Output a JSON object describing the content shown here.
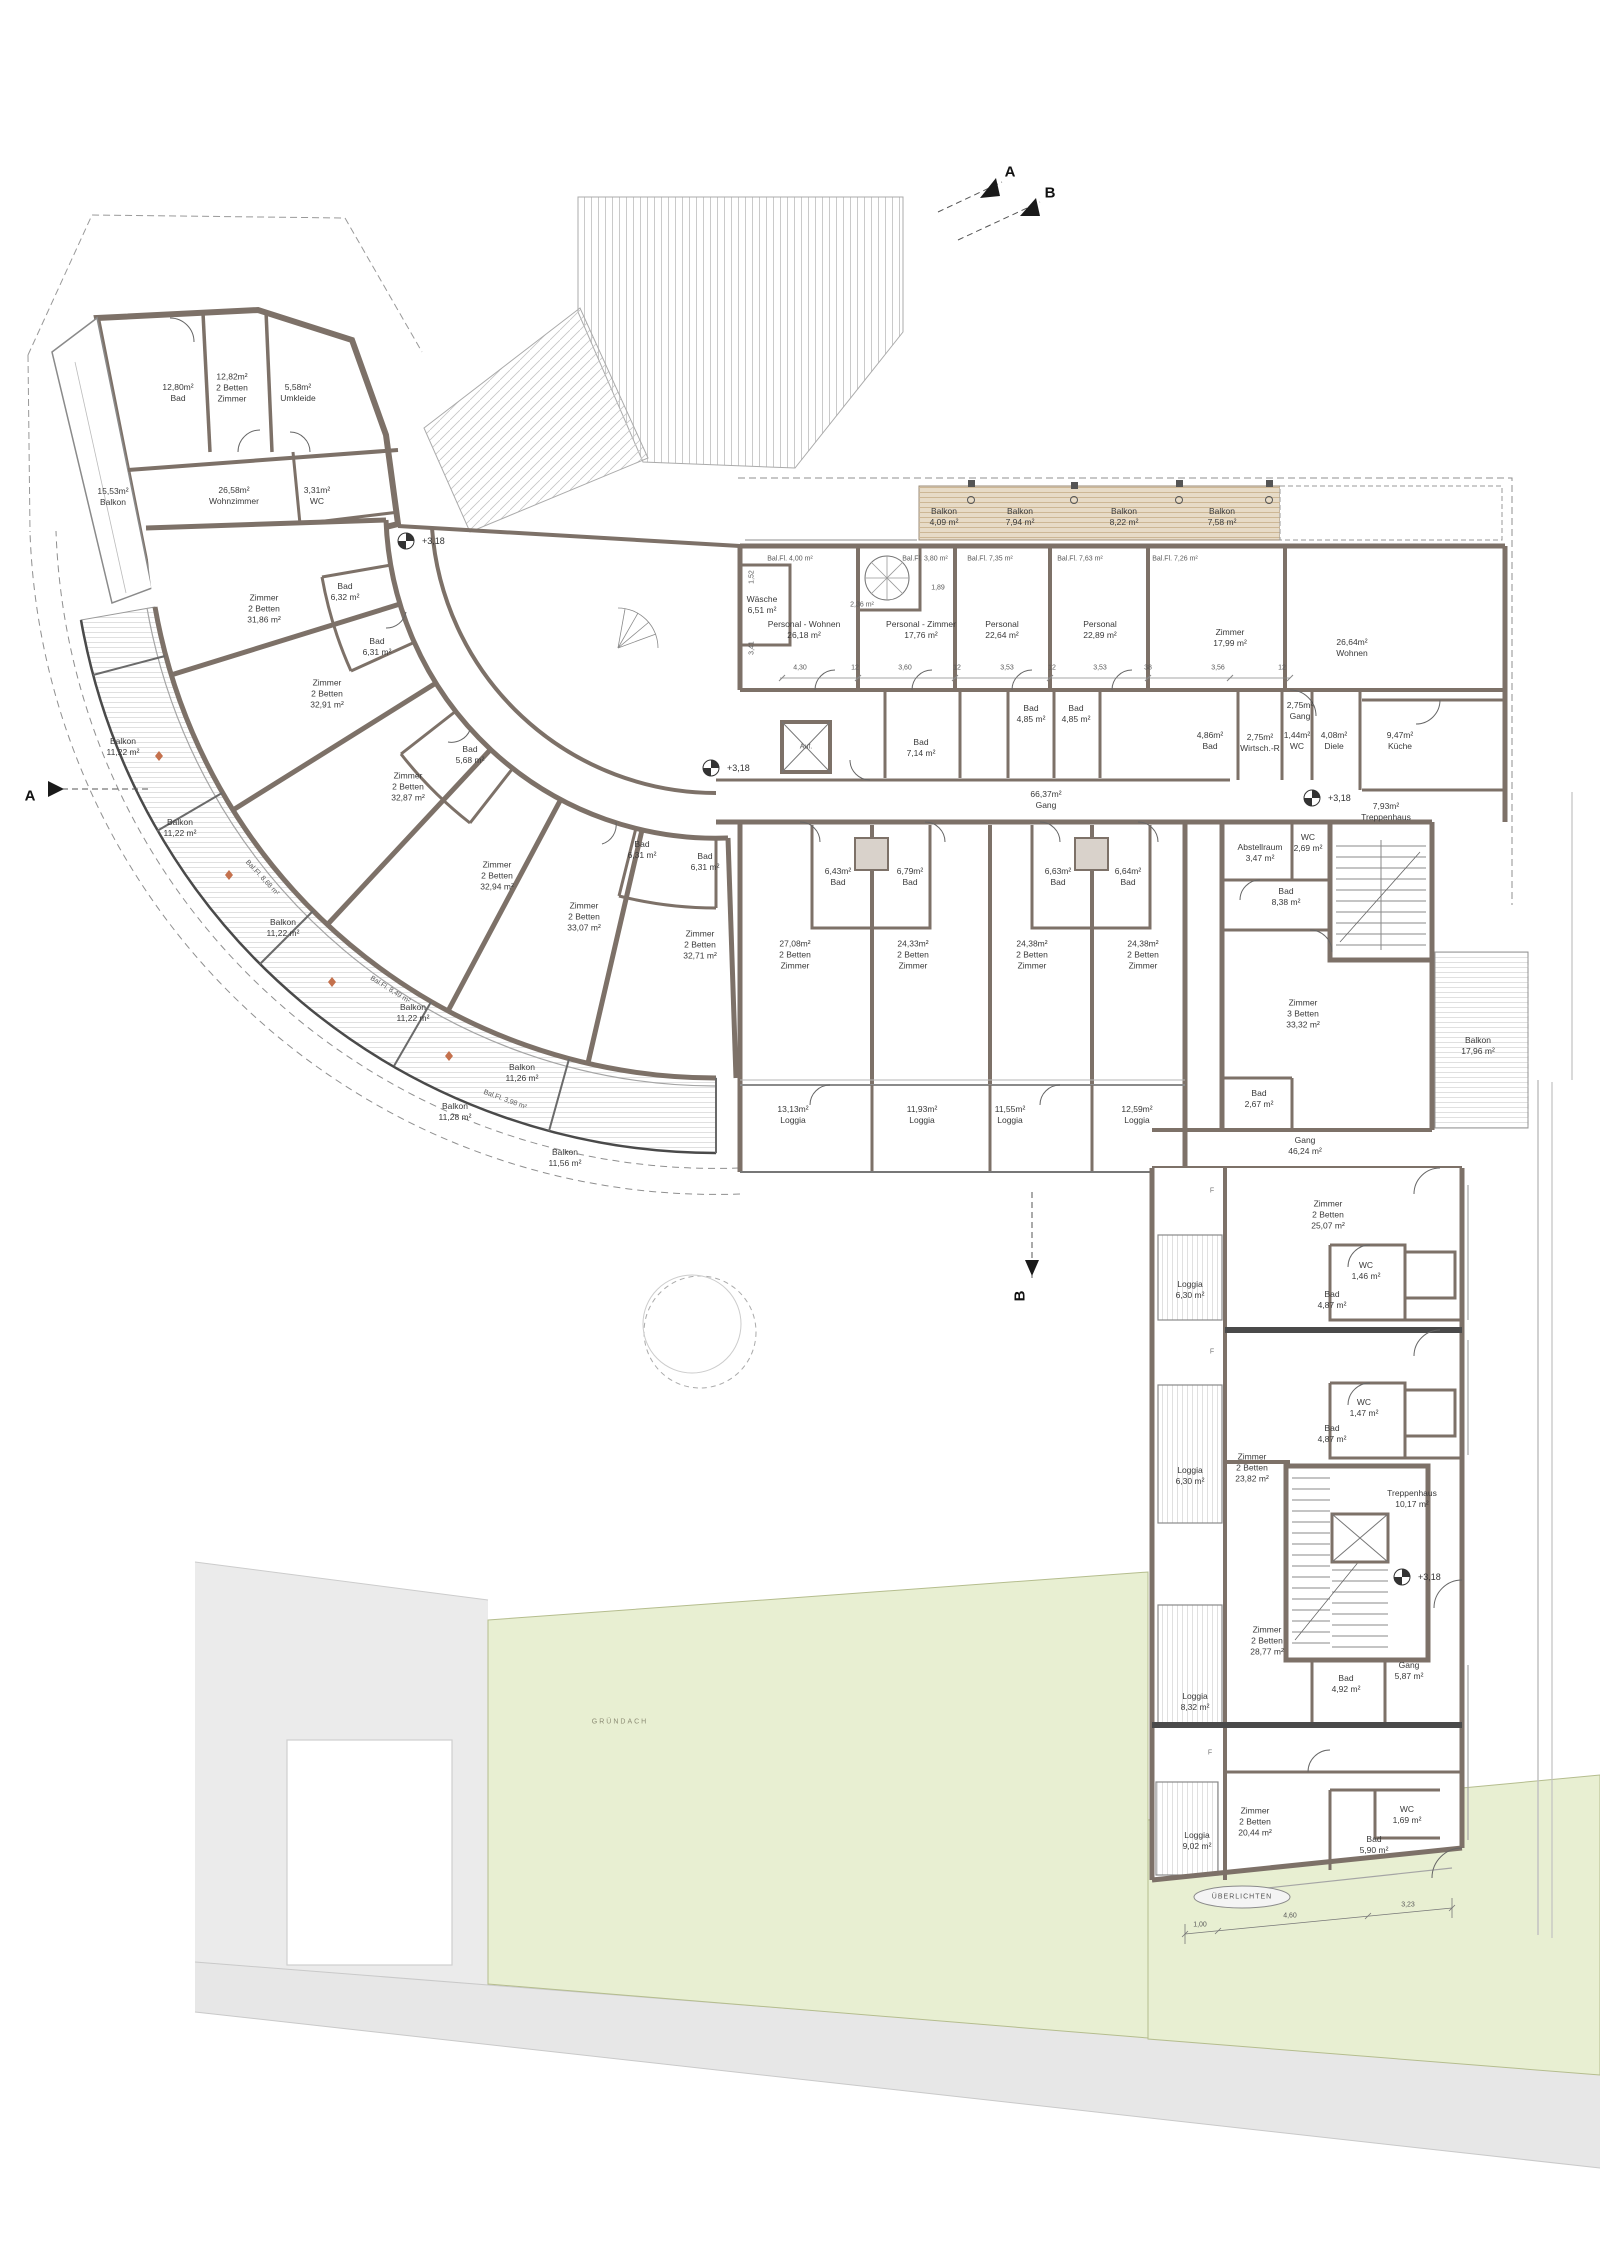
{
  "plan": {
    "level_marker": "+3,18",
    "sections": {
      "a": "A",
      "b": "B"
    },
    "f_marker": "F",
    "top_left": {
      "bad": "12,80m²\nBad",
      "zimmer": "12,82m²\n2 Betten\nZimmer",
      "umkleide": "5,58m²\nUmkleide",
      "balkon": "15,53m²\nBalkon",
      "wohnzimmer": "26,58m²\nWohnzimmer",
      "wc": "3,31m²\nWC"
    },
    "curve": {
      "rooms": [
        "Zimmer\n2 Betten\n31,86 m²",
        "Zimmer\n2 Betten\n32,91 m²",
        "Zimmer\n2 Betten\n32,87 m²",
        "Zimmer\n2 Betten\n32,94 m²",
        "Zimmer\n2 Betten\n33,07 m²",
        "Zimmer\n2 Betten\n32,71 m²"
      ],
      "bads": [
        "Bad\n6,32 m²",
        "Bad\n6,31 m²",
        "Bad\n5,68 m²",
        "Bad\n6,31 m²",
        "Bad\n6,31 m²"
      ],
      "balconies": [
        "Balkon\n11,22 m²",
        "Balkon\n11,22 m²",
        "Balkon\n11,22 m²",
        "Balkon\n11,22 m²",
        "Balkon\n11,26 m²",
        "Balkon\n11,28 m²",
        "Balkon\n11,56 m²"
      ],
      "bal_fl": [
        "Bal.Fl. 8,68 m²",
        "Bal.Fl. 8,49 m²",
        "Bal.Fl. 3,98 m²"
      ]
    },
    "mid": {
      "balconies": [
        "Balkon\n4,09 m²",
        "Balkon\n7,94 m²",
        "Balkon\n8,22 m²",
        "Balkon\n7,58 m²"
      ],
      "bal_fl": [
        "Bal.Fl. 4,00 m²",
        "Bal.Fl. 3,80 m²",
        "Bal.Fl. 7,35 m²",
        "Bal.Fl. 7,63 m²",
        "Bal.Fl. 7,26 m²"
      ],
      "waesche": "Wäsche\n6,51 m²",
      "personal_wohnen": "Personal - Wohnen\n26,18 m²",
      "personal_zimmer": "Personal - Zimmer\n17,76 m²",
      "personal_a": "Personal\n22,64 m²",
      "personal_b": "Personal\n22,89 m²",
      "zimmer": "Zimmer\n17,99 m²",
      "wohnen": "26,64m²\nWohnen",
      "bad_714": "Bad\n7,14 m²",
      "bad_485a": "Bad\n4,85 m²",
      "bad_485b": "Bad\n4,85 m²",
      "gang_klein": "2,75m²\nGang",
      "bad_486": "4,86m²\nBad",
      "wirtschaftsraum": "2,75m²\nWirtsch.-R",
      "wc_144": "1,44m²\nWC",
      "diele": "4,08m²\nDiele",
      "kueche": "9,47m²\nKüche",
      "gang": "66,37m²\nGang",
      "treppenhaus": "7,93m²\nTreppenhaus",
      "aufzug": "Auf."
    },
    "south": {
      "bads": [
        "6,43m²\nBad",
        "6,79m²\nBad",
        "6,63m²\nBad",
        "6,64m²\nBad"
      ],
      "rooms": [
        "27,08m²\n2 Betten\nZimmer",
        "24,33m²\n2 Betten\nZimmer",
        "24,38m²\n2 Betten\nZimmer",
        "24,38m²\n2 Betten\nZimmer"
      ],
      "loggias": [
        "13,13m²\nLoggia",
        "11,93m²\nLoggia",
        "11,55m²\nLoggia",
        "12,59m²\nLoggia"
      ]
    },
    "east": {
      "abstellraum": "Abstellraum\n3,47 m²",
      "wc": "WC\n2,69 m²",
      "bad": "Bad\n8,38 m²",
      "zimmer": "Zimmer\n3 Betten\n33,32 m²",
      "bad2": "Bad\n2,67 m²",
      "balkon": "Balkon\n17,96 m²",
      "gang": "Gang\n46,24 m²"
    },
    "sw": {
      "zimmer_2507": "Zimmer\n2 Betten\n25,07 m²",
      "wc_146": "WC\n1,46 m²",
      "bad_487a": "Bad\n4,87 m²",
      "loggia_630a": "Loggia\n6,30 m²",
      "zimmer_2382": "Zimmer\n2 Betten\n23,82 m²",
      "wc_147": "WC\n1,47 m²",
      "bad_487b": "Bad\n4,87 m²",
      "loggia_630b": "Loggia\n6,30 m²",
      "treppenhaus": "Treppenhaus\n10,17 m²",
      "zimmer_2877": "Zimmer\n2 Betten\n28,77 m²",
      "bad_492": "Bad\n4,92 m²",
      "gang": "Gang\n5,87 m²",
      "loggia_832": "Loggia\n8,32 m²",
      "zimmer_2044": "Zimmer\n2 Betten\n20,44 m²",
      "wc_169": "WC\n1,69 m²",
      "bad_590": "Bad\n5,90 m²",
      "loggia_902": "Loggia\n9,02 m²"
    },
    "site": {
      "gruendach": "GRÜNDACH",
      "ueberlichten": "ÜBERLICHTEN"
    },
    "dims": {
      "row": [
        "4,30",
        "12",
        "3,60",
        "12",
        "3,53",
        "12",
        "3,53",
        "38",
        "3,56",
        "12"
      ],
      "v1": "1,52",
      "v2": "3,41",
      "d189": "1,89",
      "d236": "2,36 m²",
      "bottom": [
        "1,00",
        "4,60",
        "3,23"
      ]
    }
  }
}
